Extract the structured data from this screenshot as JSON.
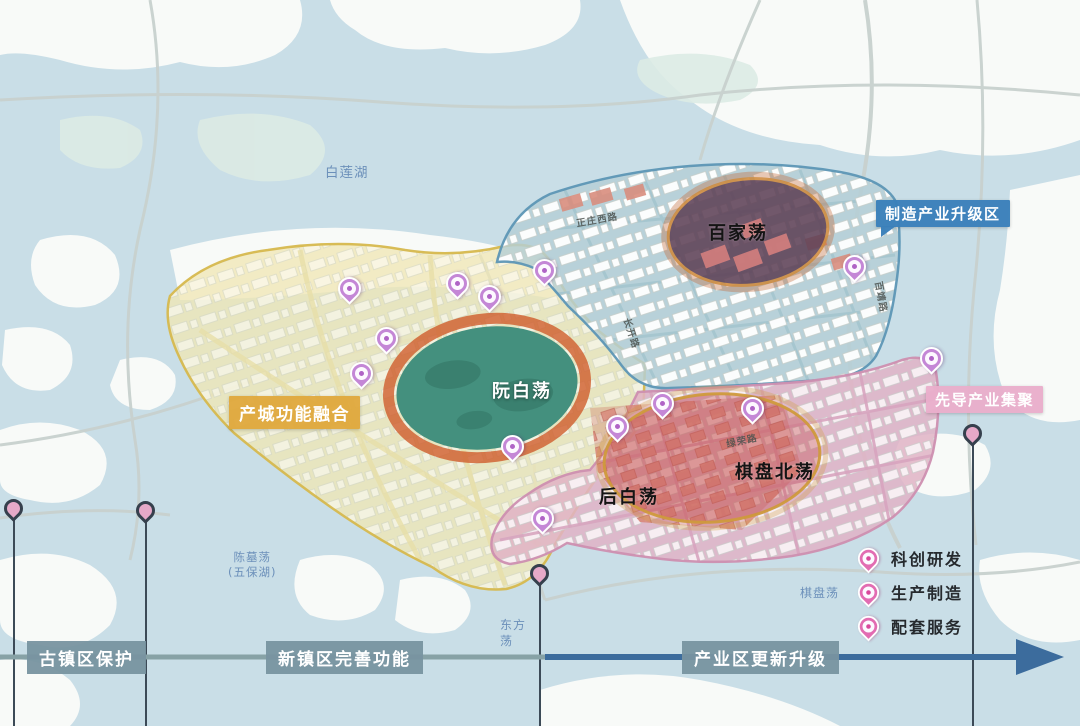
{
  "zone_labels": {
    "city_integration": "产城功能融合",
    "manufacturing_upgrade": "制造产业升级区",
    "pioneer_cluster": "先导产业集聚"
  },
  "area_labels": {
    "ruanbaidang": "阮白荡",
    "baijiadang": "百家荡",
    "houbaidang": "后白荡",
    "qipanbeidang": "棋盘北荡"
  },
  "water_labels": {
    "bailianhu": "白莲湖",
    "chenmudang": "陈墓荡\n(五保湖)",
    "dongfangdang": "东方\n荡",
    "qipandang": "棋盘荡"
  },
  "road_labels": {
    "zhengzhuang_west": "正庄西路",
    "changkai": "长开路",
    "baijing": "百靖路",
    "lvrong": "绿荣路"
  },
  "timeline": {
    "phase1": "古镇区保护",
    "phase2": "新镇区完善功能",
    "phase3": "产业区更新升级"
  },
  "legend": {
    "research": "科创研发",
    "manufacturing": "生产制造",
    "services": "配套服务"
  },
  "colors": {
    "water": "#c9dee7",
    "land": "#f8faf8",
    "zone_city_fill": "#efe7b5",
    "zone_city_border": "#d6b84e",
    "zone_manufacturing_fill": "#b5ced6",
    "zone_manufacturing_border": "#5d96b5",
    "zone_pioneer_fill": "#e0b3c6",
    "zone_pioneer_border": "#cd8fb0",
    "lake_green": "#44907e",
    "ring_orange": "#cf5c2c",
    "red_area": "#c4504e",
    "dark_lake": "#5f4257",
    "pin_purple": "#c487d6",
    "pin_pink": "#e26cb2",
    "arrow_gray": "#87a2a6",
    "arrow_blue": "#3c6c9d",
    "tag_gold": "#dfa83c",
    "tag_blue": "#3b80ba",
    "tag_pink": "#e9aecb"
  }
}
